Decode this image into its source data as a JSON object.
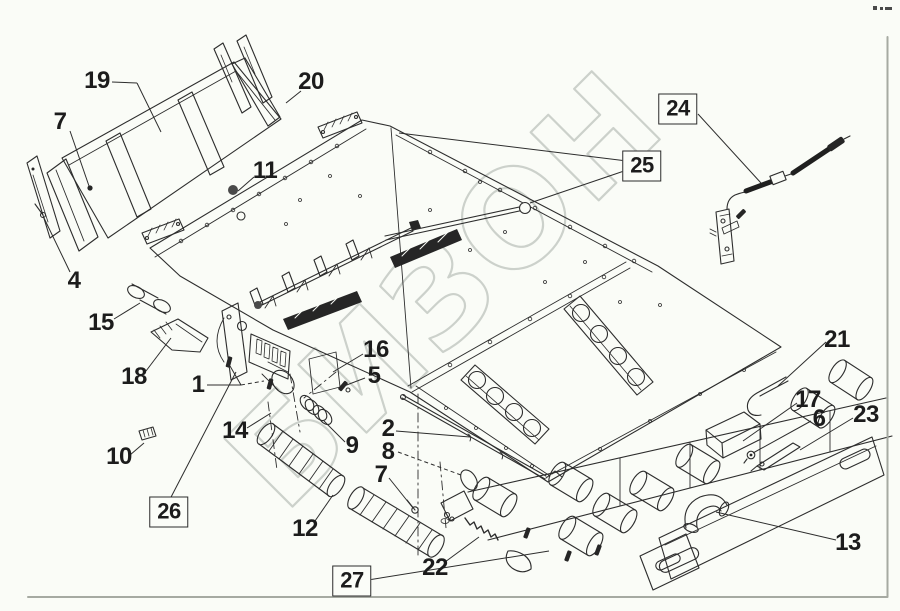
{
  "watermark": {
    "text": "БИЗОН"
  },
  "colors": {
    "background": "#fafcf7",
    "line": "#2d2d2d",
    "watermark_outline": "#ccd1cb",
    "frame_border": "#a6aaa2",
    "label_text": "#1c1c1c",
    "dark_fill": "#262626"
  },
  "callouts": [
    {
      "label": "1",
      "x": 198,
      "y": 385,
      "boxed": false,
      "leaders": [
        {
          "from": [
            207,
            385
          ],
          "to": [
            241,
            385
          ]
        },
        {
          "from": [
            241,
            385
          ],
          "to": [
            230,
            366
          ]
        },
        {
          "from": [
            241,
            385
          ],
          "to": [
            264,
            381
          ],
          "dash": true
        }
      ]
    },
    {
      "label": "2",
      "x": 388,
      "y": 429,
      "boxed": false,
      "leaders": [
        {
          "from": [
            396,
            431
          ],
          "to": [
            470,
            437
          ]
        }
      ]
    },
    {
      "label": "4",
      "x": 74,
      "y": 281,
      "boxed": false,
      "leaders": [
        {
          "from": [
            70,
            272
          ],
          "to": [
            44,
            218
          ]
        }
      ]
    },
    {
      "label": "5",
      "x": 374,
      "y": 376,
      "boxed": false,
      "leaders": [
        {
          "from": [
            365,
            378
          ],
          "to": [
            344,
            386
          ]
        }
      ]
    },
    {
      "label": "6",
      "x": 819,
      "y": 419,
      "boxed": false,
      "leaders": [
        {
          "from": [
            811,
            421
          ],
          "to": [
            753,
            453
          ]
        }
      ]
    },
    {
      "label": "7",
      "x": 60,
      "y": 122,
      "boxed": false,
      "leaders": [
        {
          "from": [
            70,
            131
          ],
          "to": [
            89,
            186
          ]
        }
      ]
    },
    {
      "label": "7",
      "x": 381,
      "y": 475,
      "boxed": false,
      "leaders": [
        {
          "from": [
            389,
            478
          ],
          "to": [
            413,
            508
          ]
        }
      ]
    },
    {
      "label": "8",
      "x": 388,
      "y": 452,
      "boxed": false,
      "leaders": [
        {
          "from": [
            398,
            452
          ],
          "to": [
            461,
            475
          ],
          "dash": true
        }
      ]
    },
    {
      "label": "9",
      "x": 352,
      "y": 446,
      "boxed": false,
      "leaders": [
        {
          "from": [
            345,
            442
          ],
          "to": [
            324,
            421
          ]
        }
      ]
    },
    {
      "label": "10",
      "x": 119,
      "y": 457,
      "boxed": false,
      "leaders": [
        {
          "from": [
            130,
            455
          ],
          "to": [
            144,
            443
          ]
        }
      ]
    },
    {
      "label": "11",
      "x": 265,
      "y": 171,
      "boxed": false,
      "leaders": [
        {
          "from": [
            254,
            177
          ],
          "to": [
            238,
            191
          ]
        }
      ]
    },
    {
      "label": "12",
      "x": 305,
      "y": 529,
      "boxed": false,
      "leaders": [
        {
          "from": [
            315,
            521
          ],
          "to": [
            333,
            495
          ]
        }
      ]
    },
    {
      "label": "13",
      "x": 848,
      "y": 543,
      "boxed": false,
      "leaders": [
        {
          "from": [
            836,
            540
          ],
          "to": [
            716,
            512
          ]
        }
      ]
    },
    {
      "label": "14",
      "x": 235,
      "y": 431,
      "boxed": false,
      "leaders": [
        {
          "from": [
            247,
            428
          ],
          "to": [
            271,
            413
          ]
        }
      ]
    },
    {
      "label": "15",
      "x": 101,
      "y": 323,
      "boxed": false,
      "leaders": [
        {
          "from": [
            114,
            319
          ],
          "to": [
            140,
            303
          ]
        }
      ]
    },
    {
      "label": "16",
      "x": 376,
      "y": 350,
      "boxed": false,
      "leaders": [
        {
          "from": [
            363,
            354
          ],
          "to": [
            333,
            372
          ]
        }
      ]
    },
    {
      "label": "17",
      "x": 808,
      "y": 400,
      "boxed": false,
      "leaders": [
        {
          "from": [
            797,
            403
          ],
          "to": [
            743,
            441
          ]
        }
      ]
    },
    {
      "label": "18",
      "x": 134,
      "y": 377,
      "boxed": false,
      "leaders": [
        {
          "from": [
            146,
            371
          ],
          "to": [
            171,
            338
          ]
        }
      ]
    },
    {
      "label": "19",
      "x": 97,
      "y": 81,
      "boxed": false,
      "leaders": [
        {
          "from": [
            112,
            82
          ],
          "to": [
            137,
            83
          ]
        },
        {
          "from": [
            137,
            83
          ],
          "to": [
            161,
            132
          ]
        }
      ]
    },
    {
      "label": "20",
      "x": 311,
      "y": 82,
      "boxed": false,
      "leaders": [
        {
          "from": [
            301,
            91
          ],
          "to": [
            286,
            103
          ]
        }
      ]
    },
    {
      "label": "21",
      "x": 837,
      "y": 340,
      "boxed": false,
      "leaders": [
        {
          "from": [
            826,
            342
          ],
          "to": [
            778,
            386
          ]
        }
      ]
    },
    {
      "label": "22",
      "x": 435,
      "y": 568,
      "boxed": false,
      "leaders": [
        {
          "from": [
            445,
            562
          ],
          "to": [
            479,
            537
          ]
        }
      ]
    },
    {
      "label": "23",
      "x": 866,
      "y": 415,
      "boxed": false,
      "leaders": [
        {
          "from": [
            853,
            418
          ],
          "to": [
            800,
            450
          ]
        }
      ]
    },
    {
      "label": "24",
      "x": 678,
      "y": 109,
      "boxed": true,
      "leaders": [
        {
          "from": [
            698,
            114
          ],
          "to": [
            761,
            183
          ]
        }
      ]
    },
    {
      "label": "25",
      "x": 642,
      "y": 166,
      "boxed": true,
      "leaders": [
        {
          "from": [
            627,
            161
          ],
          "to": [
            399,
            133
          ]
        },
        {
          "from": [
            627,
            170
          ],
          "to": [
            530,
            203
          ]
        }
      ]
    },
    {
      "label": "26",
      "x": 169,
      "y": 512,
      "boxed": true,
      "leaders": [
        {
          "from": [
            169,
            501
          ],
          "to": [
            236,
            372
          ]
        }
      ]
    },
    {
      "label": "27",
      "x": 352,
      "y": 581,
      "boxed": true,
      "leaders": [
        {
          "from": [
            368,
            580
          ],
          "to": [
            549,
            551
          ]
        }
      ]
    }
  ]
}
